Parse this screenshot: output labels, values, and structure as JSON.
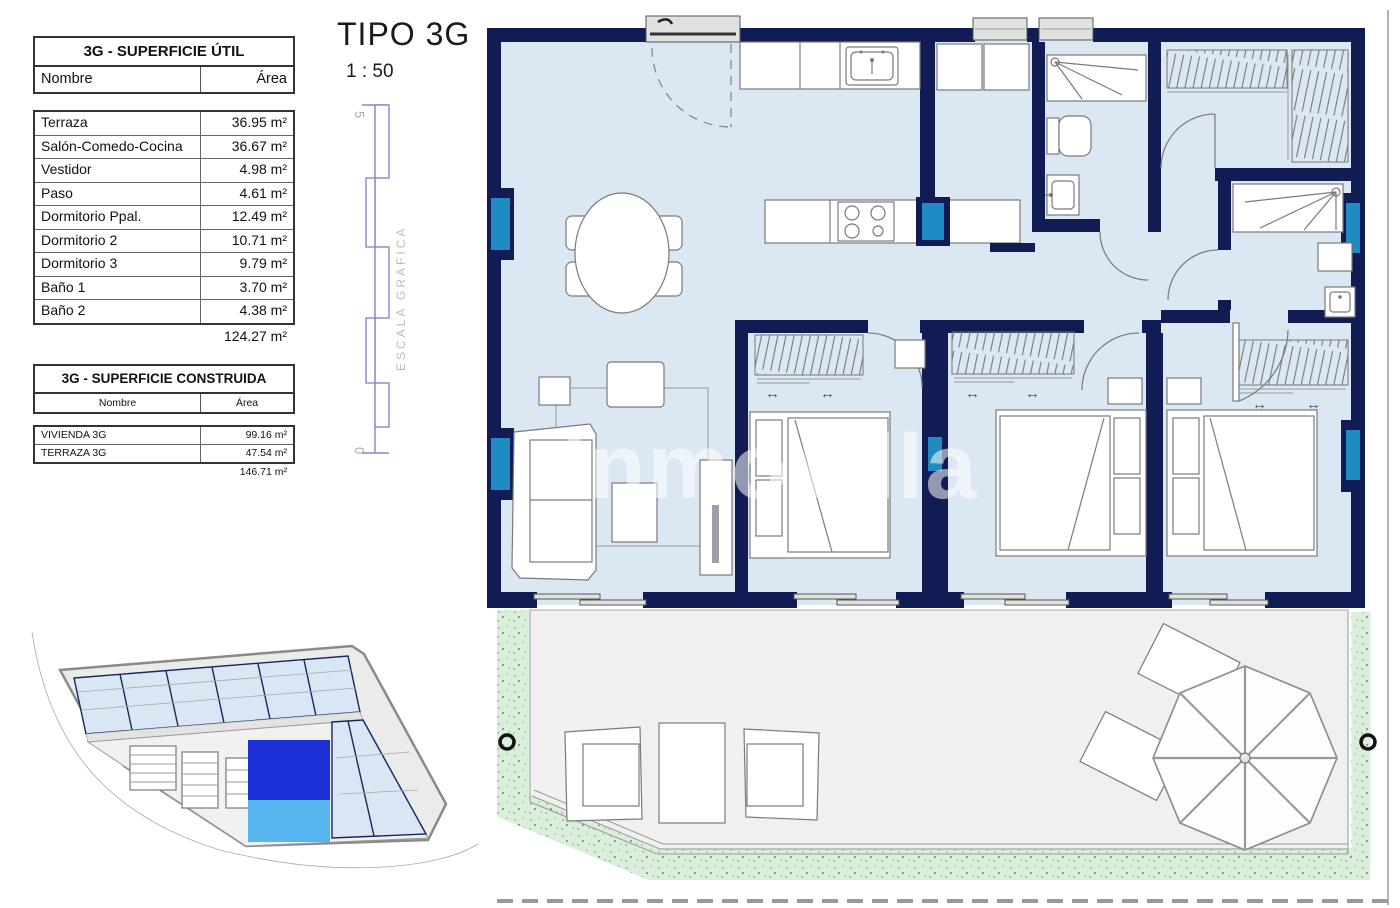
{
  "plan_header": {
    "title": "TIPO 3G",
    "scale": "1 : 50"
  },
  "left_panel": {
    "table_util": {
      "title": "3G - SUPERFICIE ÚTIL",
      "col_name": "Nombre",
      "col_area": "Área",
      "rows": [
        {
          "name": "Terraza",
          "area": "36.95 m²"
        },
        {
          "name": "Salón-Comedo-Cocina",
          "area": "36.67 m²"
        },
        {
          "name": "Vestidor",
          "area": "4.98 m²"
        },
        {
          "name": "Paso",
          "area": "4.61 m²"
        },
        {
          "name": "Dormitorio Ppal.",
          "area": "12.49 m²"
        },
        {
          "name": "Dormitorio 2",
          "area": "10.71 m²"
        },
        {
          "name": "Dormitorio 3",
          "area": "9.79 m²"
        },
        {
          "name": "Baño 1",
          "area": "3.70 m²"
        },
        {
          "name": "Baño 2",
          "area": "4.38 m²"
        }
      ],
      "total": "124.27 m²"
    },
    "table_construida": {
      "title": "3G - SUPERFICIE CONSTRUIDA",
      "col_name": "Nombre",
      "col_area": "Área",
      "rows": [
        {
          "name": "VIVIENDA 3G",
          "area": "99.16 m²"
        },
        {
          "name": "TERRAZA 3G",
          "area": "47.54 m²"
        }
      ],
      "total": "146.71 m²"
    }
  },
  "scale_bar": {
    "top_label": "5",
    "bottom_label": "0",
    "label": "ESCALA GRAFICA"
  },
  "watermark": "inmovilla",
  "icons": {
    "slide_arrow": "↔"
  },
  "colors": {
    "navy": "#121c54",
    "cyan": "#1e8cc2",
    "floor": "#dce7f4",
    "terrace": "#f0f0ee",
    "green": "#daeedb",
    "green_dot": "#8fbf97",
    "site_blue": "#d9e6f4",
    "hi_dark": "#1b2fd8",
    "hi_light": "#55b6f0",
    "scale_blue": "#8289ce"
  }
}
